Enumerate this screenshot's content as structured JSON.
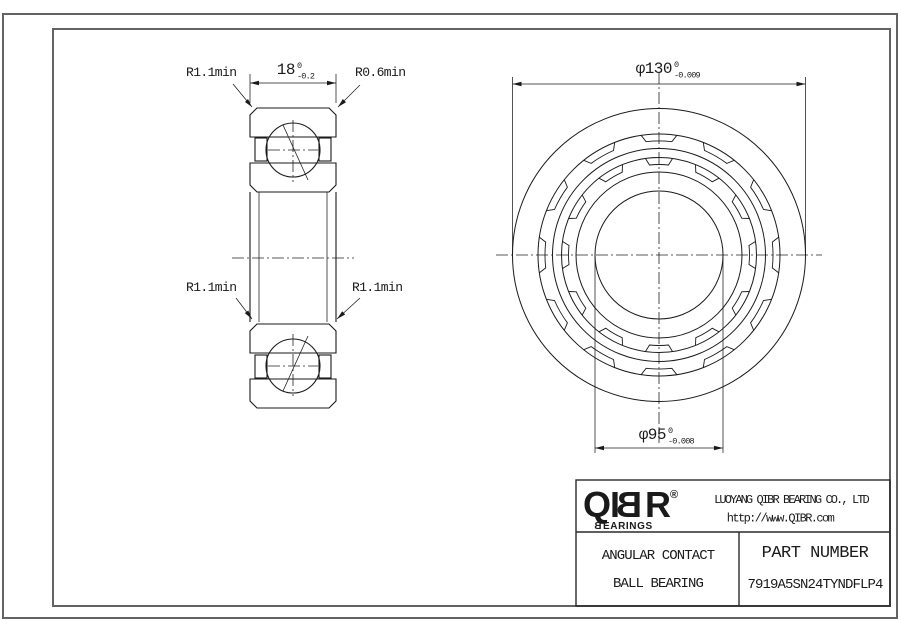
{
  "section_view": {
    "dim_width": {
      "text": "18",
      "tol_upper": "0",
      "tol_lower": "-0.2"
    },
    "labels": {
      "top_left": "R1.1min",
      "top_right": "R0.6min",
      "mid_left": "R1.1min",
      "mid_right": "R1.1min"
    }
  },
  "front_view": {
    "dim_outer_diameter": {
      "text": "φ130",
      "tol_upper": "0",
      "tol_lower": "-0.009"
    },
    "dim_bore_diameter": {
      "text": "φ95",
      "tol_upper": "0",
      "tol_lower": "-0.008"
    }
  },
  "title_block": {
    "logo": {
      "q": "Q",
      "i": "I",
      "b": "B",
      "r": "R",
      "registered": "®",
      "sub_b": "B",
      "sub_rest": "EARINGS"
    },
    "company": "LUOYANG QIBR BEARING CO., LTD",
    "website": "http://www.QIBR.com",
    "product_type_line1": "ANGULAR CONTACT",
    "product_type_line2": "BALL BEARING",
    "part_number_label": "PART NUMBER",
    "part_number": "7919A5SN24TYNDFLP4"
  },
  "colors": {
    "line": "#1a1a1a",
    "frame": "#636363",
    "background": "#ffffff"
  }
}
